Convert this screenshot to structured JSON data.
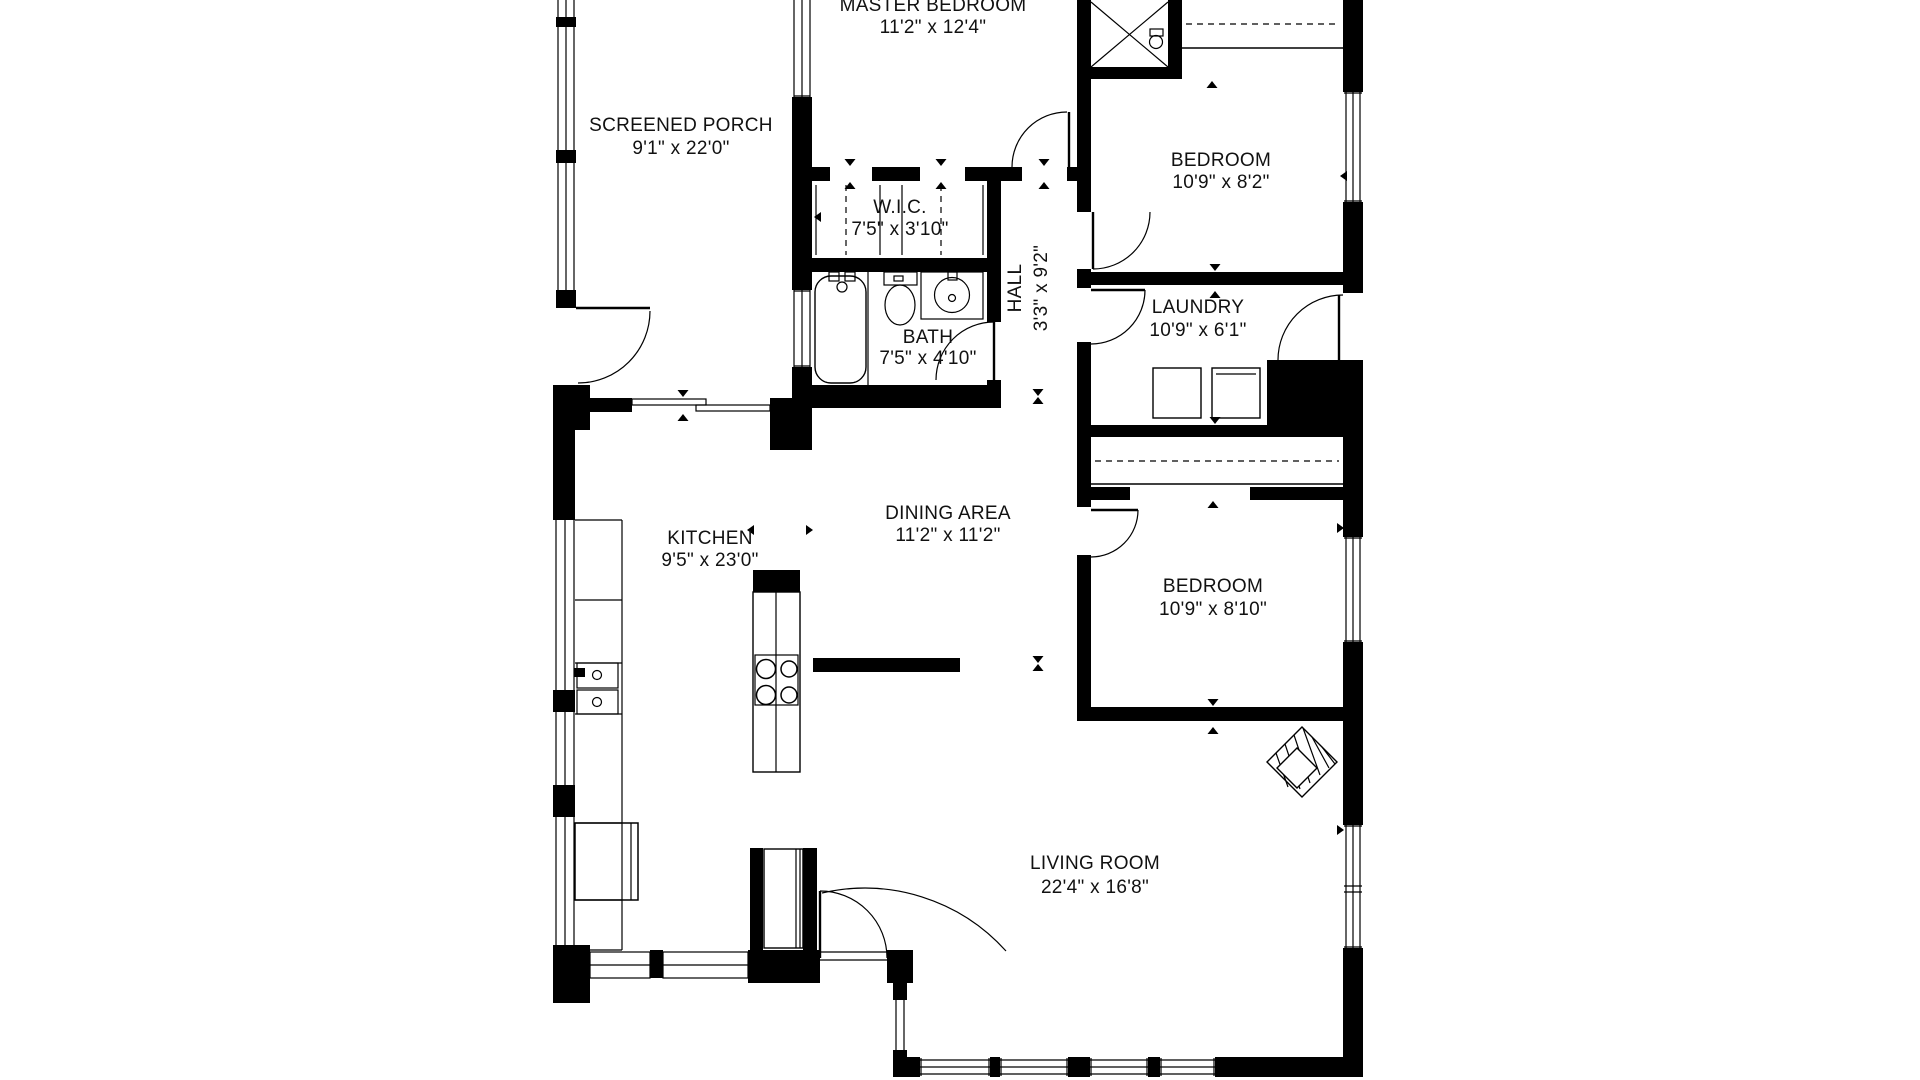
{
  "floor_plan": {
    "background_color": "#ffffff",
    "line_color": "#000000",
    "rooms": [
      {
        "id": "master-bedroom",
        "name": "MASTER BEDROOM",
        "dims": "11'2\" x 12'4\""
      },
      {
        "id": "screened-porch",
        "name": "SCREENED PORCH",
        "dims": "9'1\" x 22'0\""
      },
      {
        "id": "wic",
        "name": "W.I.C.",
        "dims": "7'5\" x 3'10\""
      },
      {
        "id": "bath",
        "name": "BATH",
        "dims": "7'5\" x 4'10\""
      },
      {
        "id": "hall",
        "name": "HALL",
        "dims": "3'3\" x 9'2\""
      },
      {
        "id": "bedroom-front",
        "name": "BEDROOM",
        "dims": "10'9\" x 8'2\""
      },
      {
        "id": "laundry",
        "name": "LAUNDRY",
        "dims": "10'9\" x 6'1\""
      },
      {
        "id": "kitchen",
        "name": "KITCHEN",
        "dims": "9'5\" x 23'0\""
      },
      {
        "id": "dining-area",
        "name": "DINING AREA",
        "dims": "11'2\" x 11'2\""
      },
      {
        "id": "bedroom-back",
        "name": "BEDROOM",
        "dims": "10'9\" x 8'10\""
      },
      {
        "id": "living-room",
        "name": "LIVING ROOM",
        "dims": "22'4\" x 16'8\""
      }
    ]
  }
}
